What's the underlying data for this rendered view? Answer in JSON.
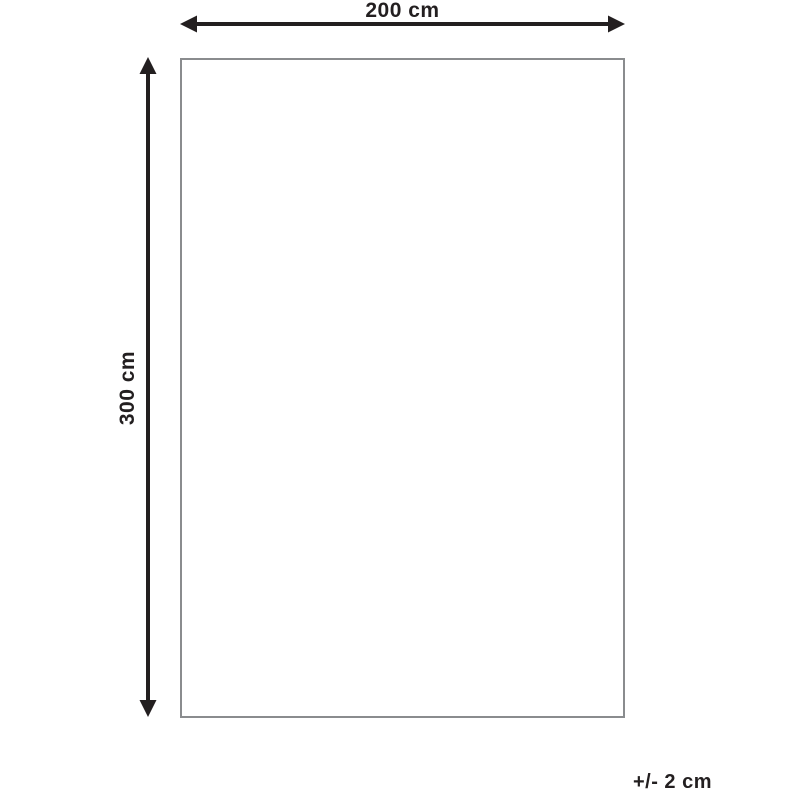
{
  "diagram": {
    "width_label": "200 cm",
    "height_label": "300 cm",
    "tolerance_label": "+/- 2 cm"
  },
  "colors": {
    "arrow": "#231f20",
    "text": "#231f20",
    "rectangle_border": "#8a8c8e",
    "background": "#ffffff"
  }
}
